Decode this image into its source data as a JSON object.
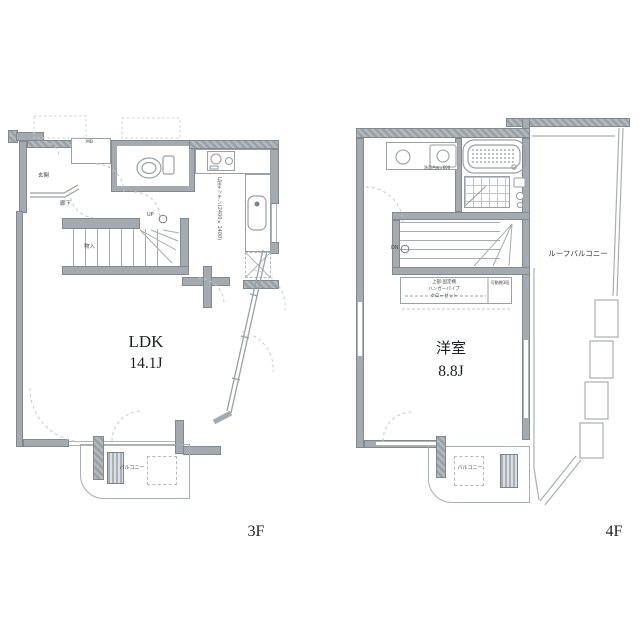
{
  "document": {
    "type": "floor-plan",
    "background": "#ffffff"
  },
  "colors": {
    "wall": "#a4aab0",
    "wall_outline": "#81888e",
    "thin_line": "#9aa0a6",
    "dash_line": "#c3c8cc",
    "small_text": "#41464b",
    "main_text": "#1c2025"
  },
  "plan_3f": {
    "floor_label": "3F",
    "room": "LDK",
    "size": "14.1J",
    "entry": "玄関",
    "hallway": "廊下",
    "storage": "物入",
    "up": "UP",
    "meter_box": "MB",
    "kitchen_note": "L型キッチン(2400×1400)",
    "balcony": "バルコニー"
  },
  "plan_4f": {
    "floor_label": "4F",
    "room": "洋室",
    "size": "8.8J",
    "down": "DN",
    "roof_balcony": "ルーフバルコニー",
    "washstand": "洗面台w=600",
    "closet_upper": "上部:固定棚",
    "closet_pipe": "ハンガーパイプ",
    "closet_name": "クローゼット",
    "movable_shelf": "可動棚3段",
    "balcony": "バルコニー"
  }
}
